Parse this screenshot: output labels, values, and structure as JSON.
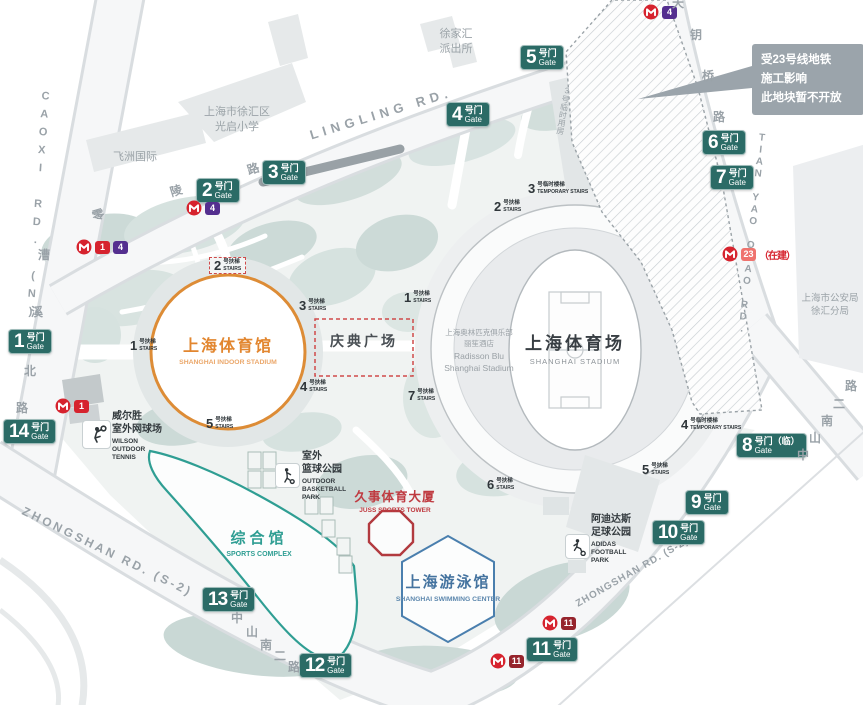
{
  "note": {
    "lines": [
      "受23号线地铁",
      "施工影响",
      "此地块暂不开放"
    ]
  },
  "gate_cn": "号门",
  "gate_en": "Gate",
  "gates": [
    {
      "num": "1",
      "x": 8,
      "y": 329
    },
    {
      "num": "2",
      "x": 196,
      "y": 178
    },
    {
      "num": "3",
      "x": 262,
      "y": 160
    },
    {
      "num": "4",
      "x": 446,
      "y": 102
    },
    {
      "num": "5",
      "x": 520,
      "y": 45
    },
    {
      "num": "6",
      "x": 702,
      "y": 130
    },
    {
      "num": "7",
      "x": 710,
      "y": 165
    },
    {
      "num": "8",
      "x": 736,
      "y": 433,
      "suffix": "（临）"
    },
    {
      "num": "9",
      "x": 685,
      "y": 490
    },
    {
      "num": "10",
      "x": 652,
      "y": 520
    },
    {
      "num": "11",
      "x": 526,
      "y": 637
    },
    {
      "num": "12",
      "x": 299,
      "y": 653
    },
    {
      "num": "13",
      "x": 202,
      "y": 587
    },
    {
      "num": "14",
      "x": 3,
      "y": 419
    }
  ],
  "stair_cn": "号扶梯",
  "stair_en": "STAIRS",
  "temp_stair_cn": "号临时楼梯",
  "temp_stair_en": "TEMPORARY STAIRS",
  "stairs": [
    {
      "num": "1",
      "x": 130,
      "y": 339
    },
    {
      "num": "2",
      "x": 209,
      "y": 257,
      "boxed": true
    },
    {
      "num": "3",
      "x": 299,
      "y": 299
    },
    {
      "num": "4",
      "x": 300,
      "y": 380
    },
    {
      "num": "5",
      "x": 206,
      "y": 417
    },
    {
      "num": "1",
      "x": 404,
      "y": 291
    },
    {
      "num": "2",
      "x": 494,
      "y": 200
    },
    {
      "num": "7",
      "x": 408,
      "y": 389
    },
    {
      "num": "6",
      "x": 487,
      "y": 478
    },
    {
      "num": "5",
      "x": 642,
      "y": 463
    },
    {
      "num": "3",
      "x": 528,
      "y": 182,
      "temp": true
    },
    {
      "num": "4",
      "x": 681,
      "y": 418,
      "temp": true
    }
  ],
  "metro": {
    "construction_note": "（在建）",
    "markers": [
      {
        "x": 643,
        "y": 4,
        "badges": [
          {
            "n": "4",
            "color": "#542f8f"
          }
        ]
      },
      {
        "x": 186,
        "y": 200,
        "badges": [
          {
            "n": "4",
            "color": "#542f8f"
          }
        ]
      },
      {
        "x": 76,
        "y": 239,
        "badges": [
          {
            "n": "1",
            "color": "#d6232e"
          },
          {
            "n": "4",
            "color": "#542f8f"
          }
        ]
      },
      {
        "x": 55,
        "y": 398,
        "badges": [
          {
            "n": "1",
            "color": "#d6232e"
          }
        ]
      },
      {
        "x": 722,
        "y": 246,
        "badges": [
          {
            "n": "23",
            "color": "#ef736e"
          }
        ],
        "note": true
      },
      {
        "x": 542,
        "y": 615,
        "badges": [
          {
            "n": "11",
            "color": "#96242c"
          }
        ]
      },
      {
        "x": 490,
        "y": 653,
        "badges": [
          {
            "n": "11",
            "color": "#96242c"
          }
        ]
      }
    ]
  },
  "roads": {
    "lingling": {
      "en": "LINGLING RD.",
      "cn": "零陵路"
    },
    "caoxi": {
      "en": "CAOXI RD. (N)",
      "cn": "漕溪北路"
    },
    "tianyao": {
      "en": "TIAN YAO QIAO RD.",
      "cn": "天钥桥路"
    },
    "zhongshan": {
      "en": "ZHONGSHAN RD. (S-2)",
      "cn": "中山南二路"
    }
  },
  "road_chars": [
    {
      "t": "零",
      "x": 92,
      "y": 206,
      "r": -17
    },
    {
      "t": "陵",
      "x": 170,
      "y": 182,
      "r": -17
    },
    {
      "t": "路",
      "x": 247,
      "y": 160,
      "r": -17
    },
    {
      "t": "漕",
      "x": 38,
      "y": 246
    },
    {
      "t": "溪",
      "x": 31,
      "y": 303
    },
    {
      "t": "北",
      "x": 24,
      "y": 362
    },
    {
      "t": "路",
      "x": 16,
      "y": 399
    },
    {
      "t": "天",
      "x": 672,
      "y": -6
    },
    {
      "t": "钥",
      "x": 690,
      "y": 26
    },
    {
      "t": "桥",
      "x": 702,
      "y": 67
    },
    {
      "t": "路",
      "x": 713,
      "y": 108
    },
    {
      "t": "中",
      "x": 231,
      "y": 609
    },
    {
      "t": "山",
      "x": 246,
      "y": 623
    },
    {
      "t": "南",
      "x": 260,
      "y": 636
    },
    {
      "t": "二",
      "x": 274,
      "y": 647
    },
    {
      "t": "路",
      "x": 288,
      "y": 658
    },
    {
      "t": "中",
      "x": 797,
      "y": 446
    },
    {
      "t": "山",
      "x": 809,
      "y": 429
    },
    {
      "t": "南",
      "x": 821,
      "y": 412
    },
    {
      "t": "二",
      "x": 833,
      "y": 395
    },
    {
      "t": "路",
      "x": 845,
      "y": 377
    }
  ],
  "facilities": {
    "indoor_stadium": {
      "cn": "上海体育馆",
      "en": "SHANGHAI INDOOR STADIUM"
    },
    "stadium": {
      "cn": "上海体育场",
      "en": "SHANGHAI STADIUM"
    },
    "celebration_square": {
      "cn": "庆典广场"
    },
    "swimming_center": {
      "cn": "上海游泳馆",
      "en": "SHANGHAI SWIMMING CENTER"
    },
    "sports_complex": {
      "cn": "综合馆",
      "en": "SPORTS COMPLEX"
    },
    "juss_tower": {
      "cn": "久事体育大厦",
      "en": "JUSS SPORTS TOWER"
    },
    "wilson_tennis": {
      "cn1": "威尔胜",
      "cn2": "室外网球场",
      "en1": "WILSON",
      "en2": "OUTDOOR",
      "en3": "TENNIS"
    },
    "basketball_park": {
      "cn1": "室外",
      "cn2": "篮球公园",
      "en1": "OUTDOOR",
      "en2": "BASKETBALL",
      "en3": "PARK"
    },
    "adidas_park": {
      "cn1": "阿迪达斯",
      "cn2": "足球公园",
      "en1": "ADIDAS",
      "en2": "FOOTBALL",
      "en3": "PARK"
    },
    "radisson": {
      "l1": "上海奥林匹克俱乐部",
      "l2": "丽笙酒店",
      "l3": "Radisson Blu",
      "l4": "Shanghai Stadium"
    }
  },
  "landmarks": {
    "police_station": {
      "l1": "徐家汇",
      "l2": "派出所"
    },
    "school": {
      "l1": "上海市徐汇区",
      "l2": "光启小学"
    },
    "feizhou": {
      "l1": "飞洲国际"
    },
    "psb": {
      "l1": "上海市公安局",
      "l2": "徐汇分局"
    },
    "temp_building": {
      "l1": "3号临时用房"
    }
  },
  "colors": {
    "gate": "#2b6b66",
    "metro_logo": "#d6232e",
    "line_1": "#d6232e",
    "line_4": "#542f8f",
    "line_11": "#96242c",
    "line_23": "#ef736e",
    "indoor_stadium_accent": "#e2862f",
    "stadium_text": "#383e43",
    "swimming_accent": "#44739f",
    "complex_accent": "#2f9e93",
    "juss_accent": "#bf3a40",
    "celebration_square_border": "#cf4a4a",
    "closed_area_note_bg": "#9ba4ab"
  }
}
